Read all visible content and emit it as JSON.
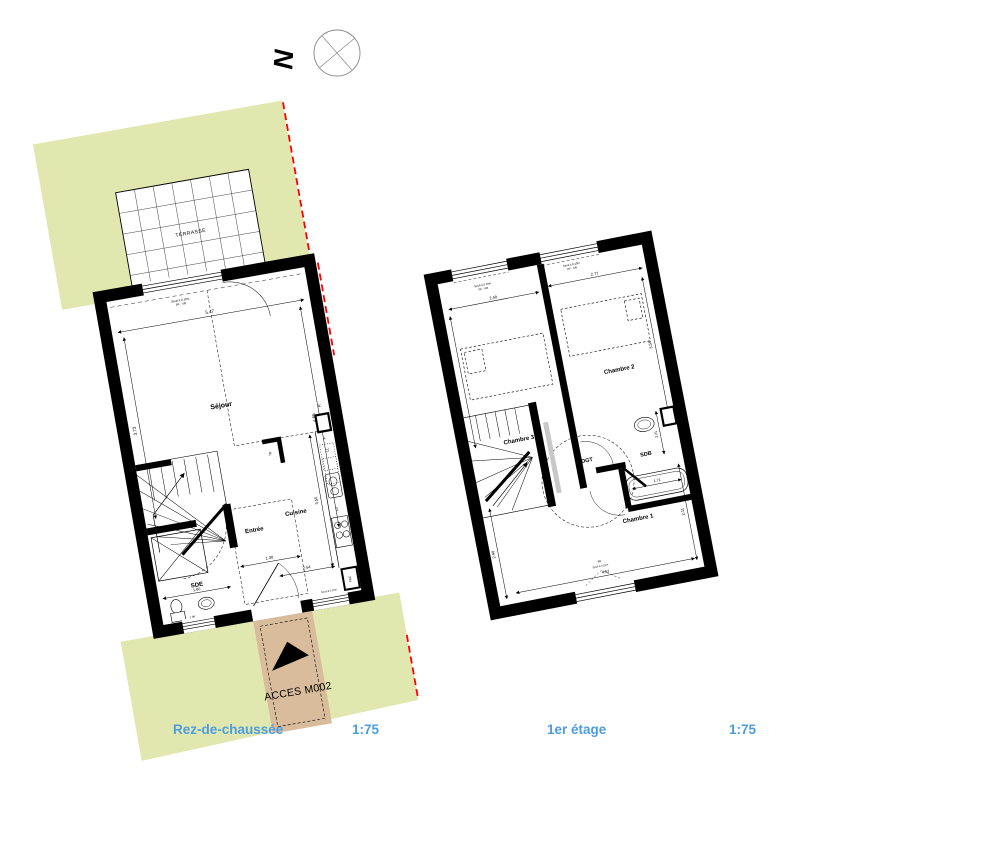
{
  "colors": {
    "garden": "#e1e8af",
    "path_tan": "#d9bc9c",
    "boundary_red": "#ff0000",
    "caption_blue": "#4d9dde",
    "wall_black": "#000000"
  },
  "compass": {
    "north_label": "N"
  },
  "ground_floor": {
    "caption": "Rez-de-chaussée",
    "scale": "1:75",
    "terrace_label": "TERRASSE",
    "access_label": "ACCES M002",
    "rooms": {
      "sejour": "Séjour",
      "entree": "Entrée",
      "cuisine": "Cuisine",
      "sde": "SDE"
    },
    "equipment": {
      "fridge": "R",
      "washer": "LL",
      "dishwasher": "LV",
      "freezer": "F",
      "heat_pump": "PAC",
      "elec_board": "TB"
    },
    "windows": {
      "seuil": "Seuil à 0.10m",
      "type": "PF : VR"
    },
    "dims": {
      "sejour_width": "5.47",
      "sejour_left": "3.73",
      "sejour_right": "4.65",
      "cuisine_depth": "3.50",
      "cuisine_width": "2.54",
      "entree_width": "1.30",
      "sde_width": "1.60",
      "sde_inner": "1.86"
    }
  },
  "first_floor": {
    "caption": "1er étage",
    "scale": "1:75",
    "rooms": {
      "chambre1": "Chambre 1",
      "chambre2": "Chambre 2",
      "chambre3": "Chambre 3",
      "dgt": "DGT",
      "sdb": "SDB"
    },
    "windows": {
      "seuil": "Seuil à 0.10m",
      "type": "PF : VR",
      "bottom_type": "PF"
    },
    "dims": {
      "window3": "2.40",
      "window2": "2.77",
      "chambre2_depth": "3.54",
      "bath": "1.71",
      "sdb_depth": "2.21",
      "chambre1_left": "2.40",
      "chambre1_width": "4.52",
      "chambre1_right": "2.11"
    }
  }
}
